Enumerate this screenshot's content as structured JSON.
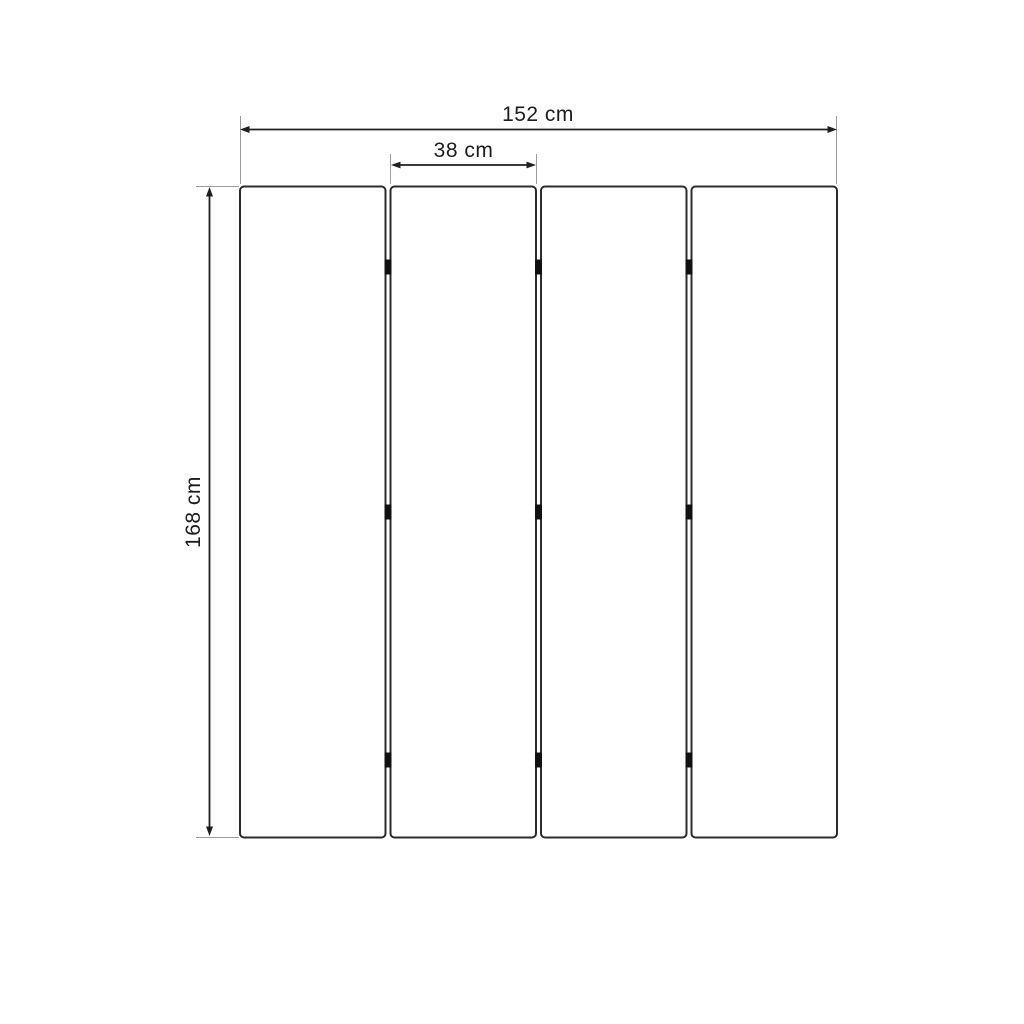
{
  "diagram": {
    "type": "dimension-drawing",
    "subject": "four-panel folding screen front view",
    "panels": {
      "count": 4
    },
    "hinges": {
      "gaps": 3,
      "rows_per_gap": 3
    },
    "dimensions": {
      "total_width": {
        "label": "152 cm",
        "value": 152,
        "unit": "cm"
      },
      "panel_width": {
        "label": "38 cm",
        "value": 38,
        "unit": "cm"
      },
      "height": {
        "label": "168 cm",
        "value": 168,
        "unit": "cm"
      }
    },
    "colors": {
      "background": "#ffffff",
      "panel_outline": "#2b2b2b",
      "dimension_line": "#1f1f1f",
      "extension_line": "#9b9b9b",
      "hinge": "#111111",
      "text": "#1c1c1c"
    }
  }
}
